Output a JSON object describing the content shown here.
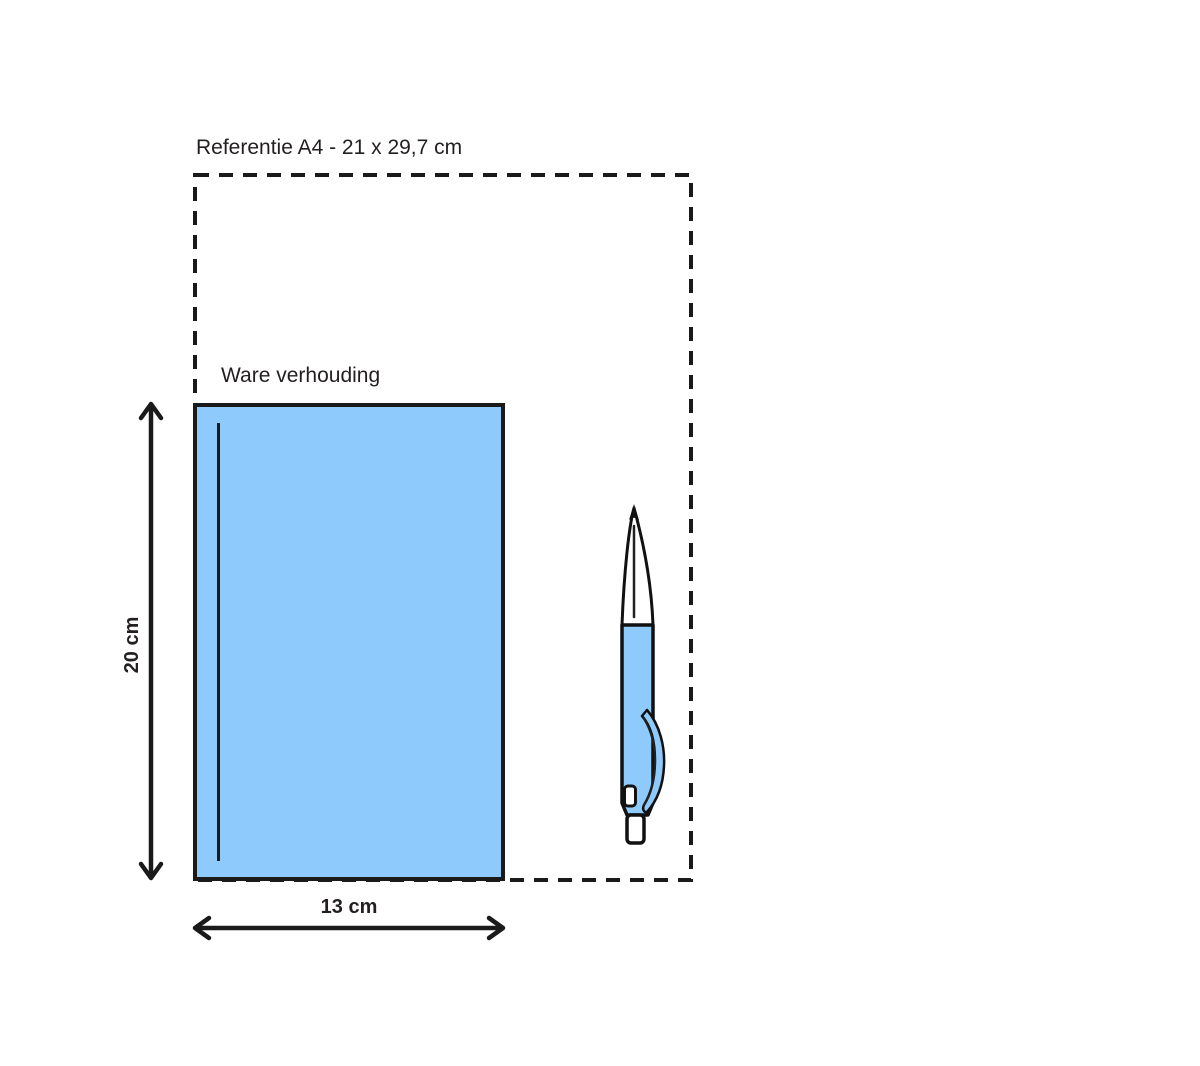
{
  "diagram": {
    "reference_label": "Referentie A4 - 21 x 29,7 cm",
    "scale_label": "Ware verhouding",
    "height_label": "20 cm",
    "width_label": "13 cm"
  },
  "colors": {
    "item_fill": "#8ECAFB",
    "line": "#1a1a1a"
  },
  "icons": {
    "pen_icon": "ballpoint-pen"
  }
}
